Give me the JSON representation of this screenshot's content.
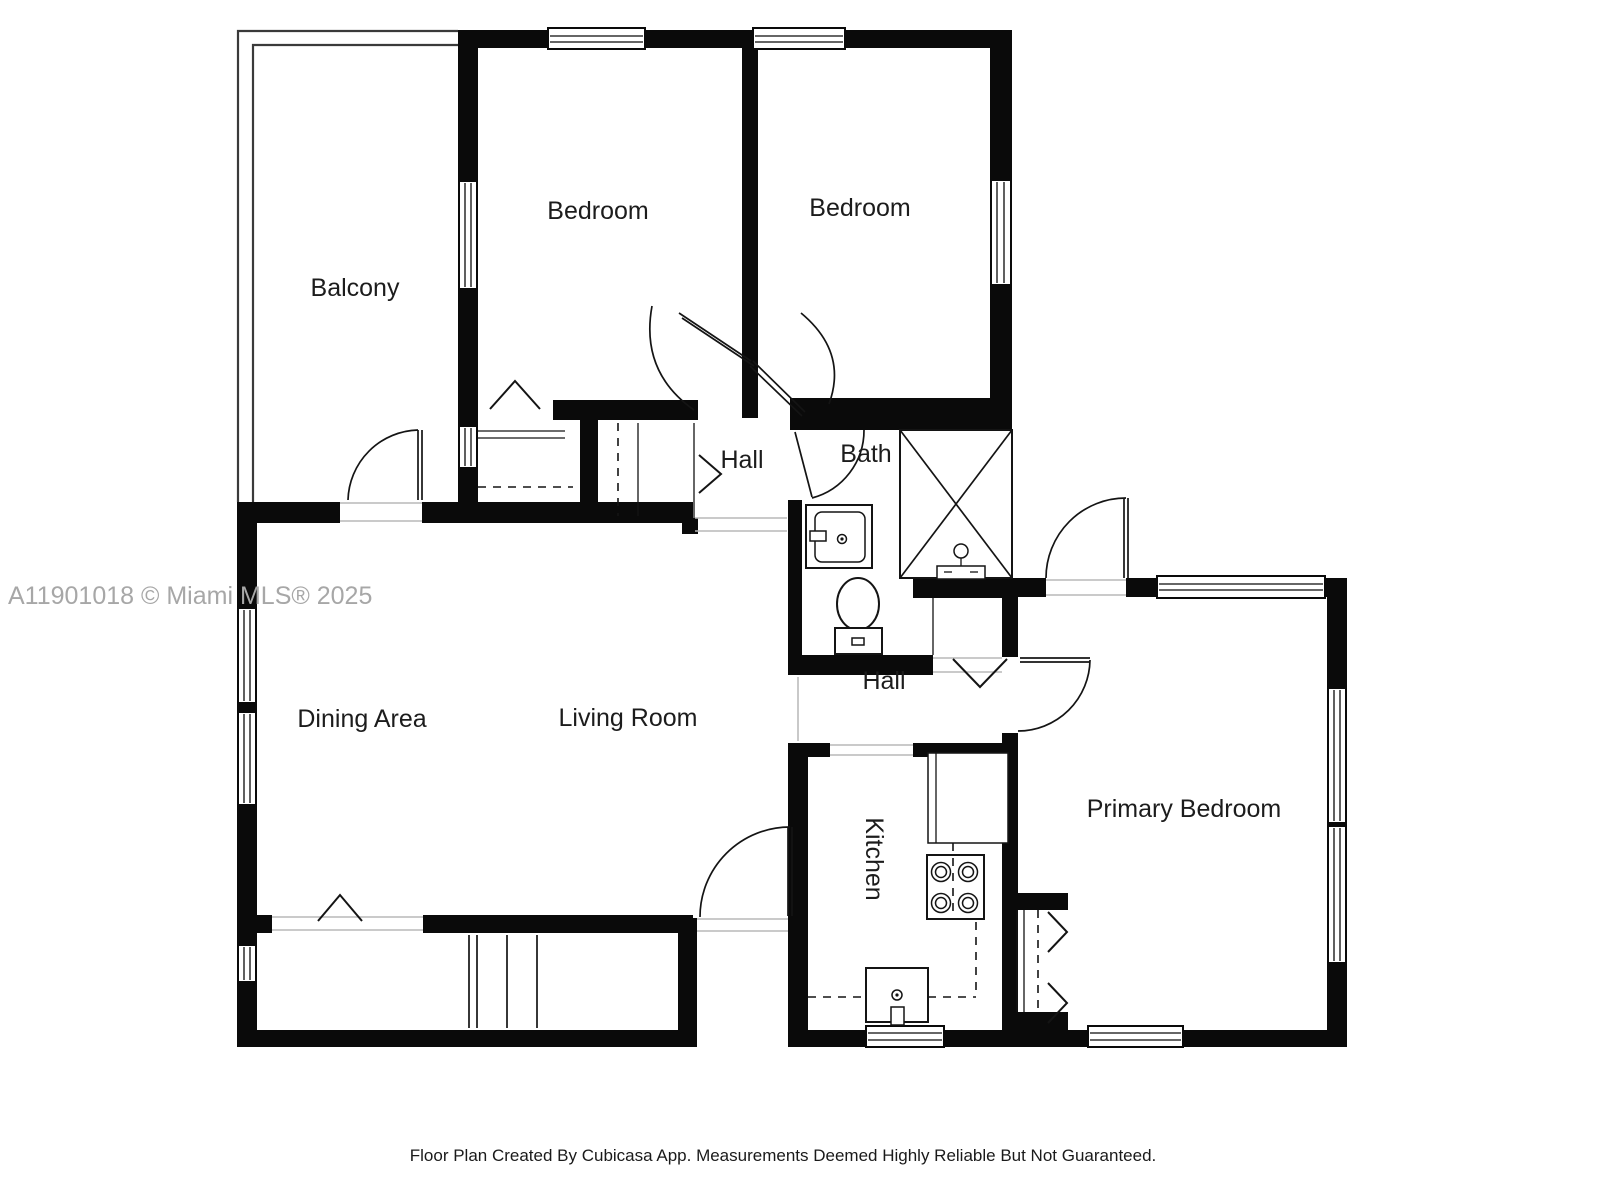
{
  "watermark": "A11901018 © Miami MLS® 2025",
  "footer": "Floor Plan Created By Cubicasa App. Measurements Deemed Highly Reliable But Not Guaranteed.",
  "rooms": {
    "balcony": "Balcony",
    "bedroom_left": "Bedroom",
    "bedroom_right": "Bedroom",
    "hall_upper": "Hall",
    "bath": "Bath",
    "hall_lower": "Hall",
    "dining": "Dining Area",
    "living": "Living Room",
    "kitchen": "Kitchen",
    "primary": "Primary Bedroom"
  },
  "colors": {
    "wall": "#0a0a0a",
    "label": "#1c1c1c",
    "watermark": "#a7a7a7"
  }
}
